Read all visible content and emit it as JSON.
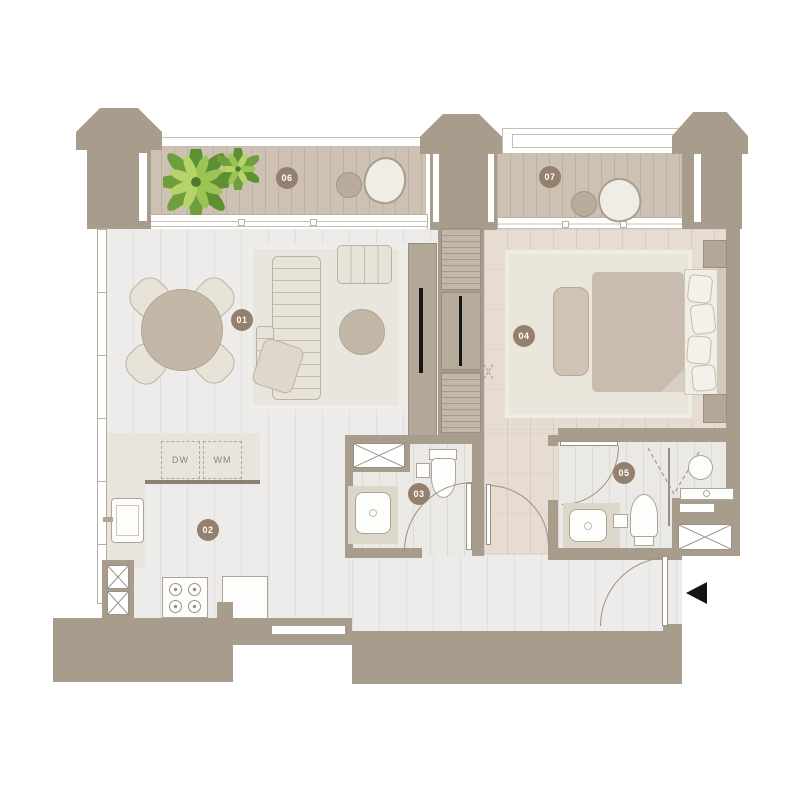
{
  "plan_title": "apartment-floor-plan",
  "labels": {
    "r01": "01",
    "r02": "02",
    "r03": "03",
    "r04": "04",
    "r05": "05",
    "r06": "06",
    "r07": "07",
    "dishwasher": "DW",
    "washing_machine": "WM"
  },
  "rooms": [
    {
      "number": "01",
      "type": "living-dining-room"
    },
    {
      "number": "02",
      "type": "kitchen"
    },
    {
      "number": "03",
      "type": "bathroom"
    },
    {
      "number": "04",
      "type": "bedroom"
    },
    {
      "number": "05",
      "type": "bathroom"
    },
    {
      "number": "06",
      "type": "balcony-terrace"
    },
    {
      "number": "07",
      "type": "balcony-terrace"
    }
  ],
  "appliances": [
    {
      "code": "DW",
      "name": "dishwasher"
    },
    {
      "code": "WM",
      "name": "washing machine"
    }
  ],
  "icons": {
    "entrance_marker": "left-pointing-triangle"
  },
  "colors": {
    "wall": "#a89c8d",
    "balcony_floor": "#cdc1b4",
    "interior_floor": "#edecea",
    "bedroom_floor": "#e6dcd2",
    "rug": "#e9e6df",
    "furniture": "#e8e3d8",
    "mattress": "#c8bcae",
    "badge": "#94806c",
    "plant": "#6f9e3c",
    "entry_marker": "#141414"
  }
}
